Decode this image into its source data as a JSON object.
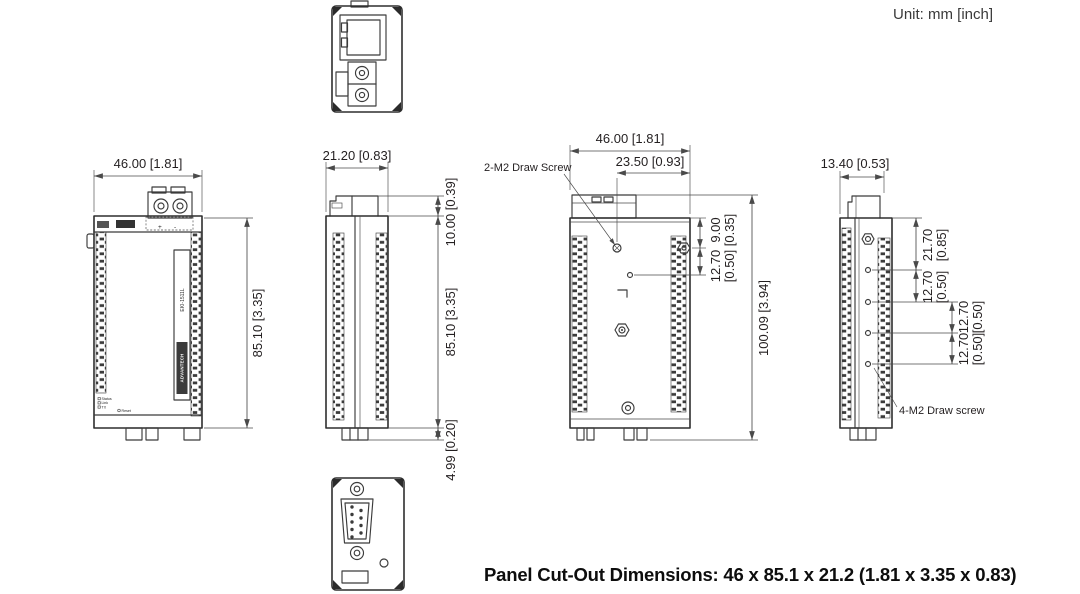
{
  "unit_note": "Unit: mm [inch]",
  "footer": "Panel Cut-Out Dimensions: 46 x 85.1 x 21.2 (1.81 x 3.35 x 0.83)",
  "colors": {
    "line": "#3b3b3b",
    "dimension": "#4a4a4a",
    "text": "#231f20"
  },
  "device": {
    "brand": "ADVANTECH",
    "model": "EKI-1511L"
  },
  "front_view": {
    "width_dim": "46.00 [1.81]",
    "height_dim": "85.10 [3.35]",
    "terminal_plus": "+",
    "terminal_minus": "-",
    "leds": [
      "Status",
      "Link",
      "TX",
      "Reset"
    ]
  },
  "side_view": {
    "width_dim": "21.20 [0.83]",
    "top_dim": "10.00 [0.39]",
    "height_dim": "85.10 [3.35]",
    "bottom_dim": "4.99 [0.20]"
  },
  "rear_view": {
    "width_dim": "46.00 [1.81]",
    "screw_span_dim": "23.50 [0.93]",
    "callout": "2-M2 Draw Screw",
    "total_height_dim": "100.09 [3.94]",
    "side_dims": [
      {
        "mm": "9.00",
        "inch": "[0.35]"
      },
      {
        "mm": "12.70",
        "inch": "[0.50]"
      }
    ]
  },
  "right_view": {
    "width_dim": "13.40 [0.53]",
    "callout": "4-M2 Draw screw",
    "side_dims": [
      {
        "mm": "21.70",
        "inch": "[0.85]"
      },
      {
        "mm": "12.70",
        "inch": "[0.50]"
      },
      {
        "mm": "12.70",
        "inch": "[0.50]"
      },
      {
        "mm": "12.70",
        "inch": "[0.50]"
      }
    ]
  }
}
